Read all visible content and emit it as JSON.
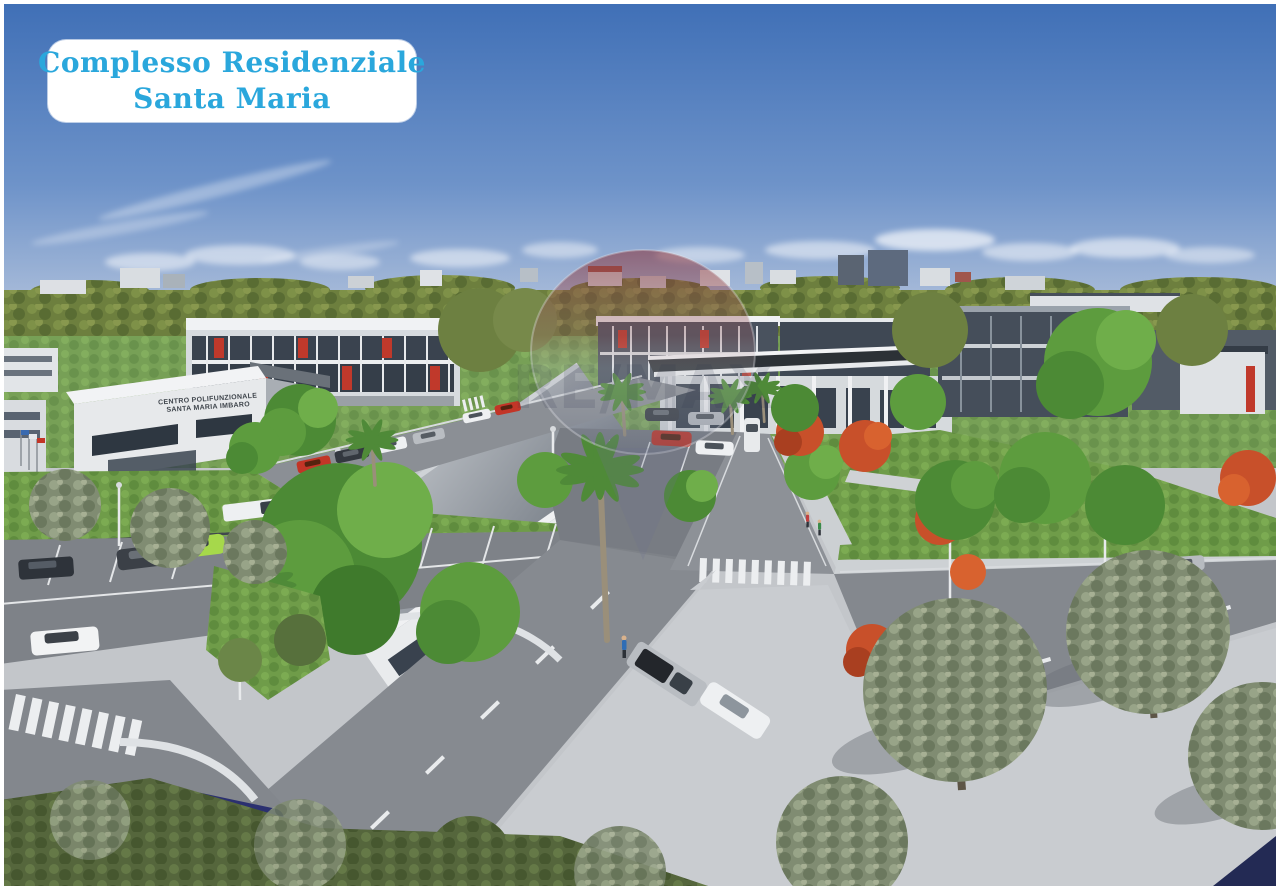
{
  "badge": {
    "line1": "Complesso Residenziale",
    "line2": "Santa Maria"
  },
  "building_sign": {
    "line1": "CENTRO POLIFUNZIONALE",
    "line2": "SANTA MARIA IMBARO"
  },
  "watermark": {
    "label": "RE/MAX",
    "type": "hot-air-balloon-watermark"
  },
  "colors": {
    "badge_bg": "#ffffff",
    "badge_text": "#2aa7dc",
    "sky_top": "#3f6fb6",
    "sky_horizon": "#b9c7de",
    "treeline_green": "#6d7f3e",
    "grass_green": "#6f9c49",
    "asphalt_gray": "#868a90",
    "pavement_light": "#c9ccd0",
    "building_white": "#edeff1",
    "building_dark": "#49525e",
    "balcony_accent_red": "#c0392b",
    "watermark_red": "#8a3438",
    "watermark_letters": "#2d324a",
    "car_navy": "#2b3070",
    "car_lime": "#a6d84b"
  },
  "scene": {
    "description": "Aerial 3D architectural rendering of the Santa Maria residential complex: white apartment buildings with red balcony accents, a multipurpose centre, internal roads with crosswalks, parking areas with cars, gardens, palm and olive trees under a blue sky"
  }
}
